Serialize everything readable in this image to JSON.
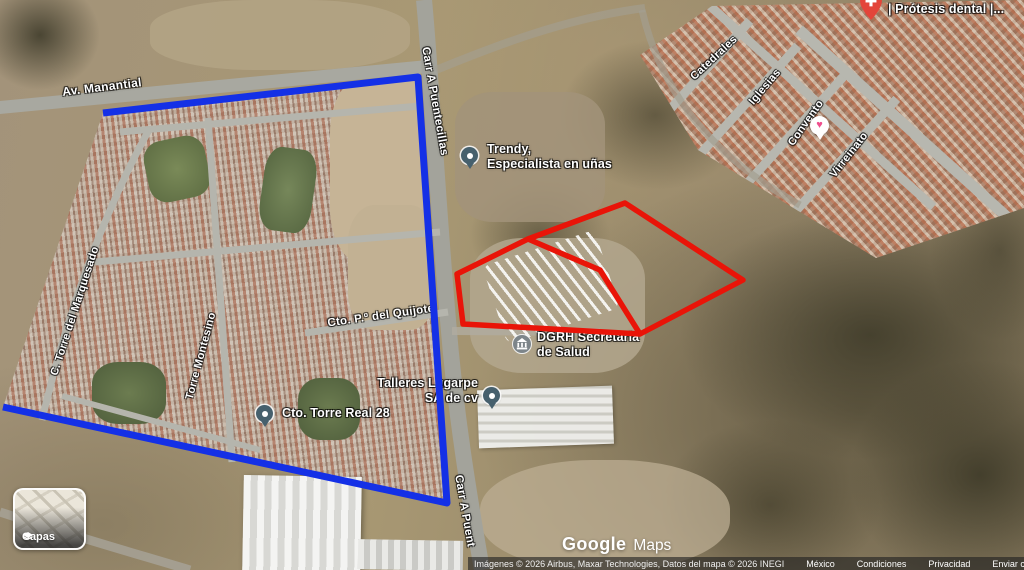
{
  "streets": {
    "av_manantial": "Av. Manantial",
    "carr_a_puentecillas": "Carr A Puentecillas",
    "carr_a_puentecillas_bottom": "Carr A Puent",
    "torre_del_marquesado": "C. Torre del Marquesado",
    "torre_montesino": "Torre Montesino",
    "paseo_del_quijote": "Cto. P.º del Quijote",
    "catedrales": "Catedrales",
    "iglesias": "Iglesias",
    "convento": "Convento",
    "virreinato": "Virreinato"
  },
  "pois": {
    "trendy": {
      "line1": "Trendy,",
      "line2": "Especialista en uñas"
    },
    "dgrh": {
      "line1": "DGRH Secretaria",
      "line2": "de Salud"
    },
    "talleres": {
      "line1": "Talleres Lugarpe",
      "line2": "SA de cv"
    },
    "torre_real": {
      "label": "Cto. Torre Real 28"
    },
    "dentista": {
      "line1": "Dentista KINEDENTAL",
      "line2": "| Prótesis dental |..."
    },
    "heart_icon": "♥"
  },
  "controls": {
    "layers_button": "Capas"
  },
  "watermark": {
    "brand": "Google",
    "product": "Maps"
  },
  "attribution": {
    "imagery": "Imágenes © 2026 Airbus, Maxar Technologies, Datos del mapa © 2026 INEGI",
    "links": [
      "México",
      "Condiciones",
      "Privacidad",
      "Enviar comentarios"
    ]
  },
  "annotations": {
    "blue_color": "#1430e6",
    "red_color": "#e91408",
    "blue_polygon_points": "103,113 418,77 447,503 3,407",
    "red_polygon_path": "M457,274 L528,239 L625,203 L743,280 L640,334 L600,270 L528,239 M457,274 L463,324 L640,334"
  }
}
